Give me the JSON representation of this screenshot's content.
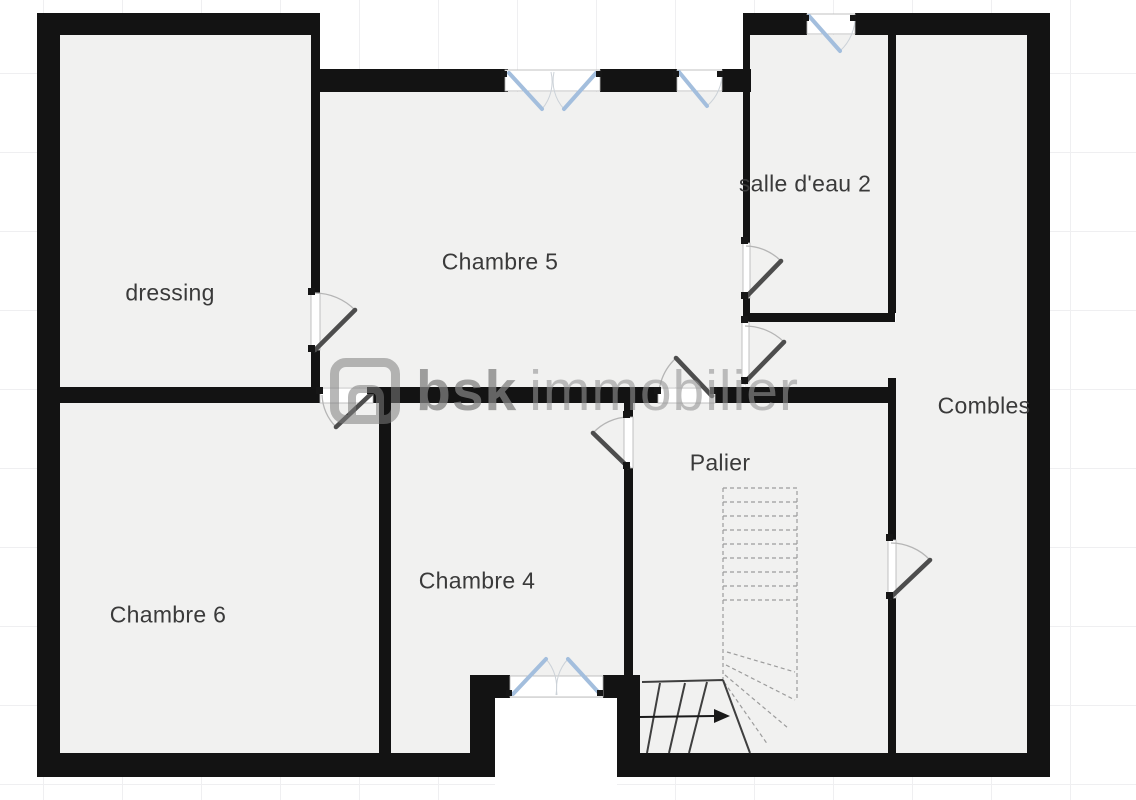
{
  "floorplan": {
    "rooms": [
      {
        "name": "dressing"
      },
      {
        "name": "Chambre 5"
      },
      {
        "name": "salle d'eau 2"
      },
      {
        "name": "Combles"
      },
      {
        "name": "Palier"
      },
      {
        "name": "Chambre 4"
      },
      {
        "name": "Chambre 6"
      }
    ],
    "watermark": {
      "bold": "bsk",
      "rest": "immobilier"
    },
    "stairs": {
      "arrow_direction": "right"
    },
    "colors": {
      "wall": "#131313",
      "room": "#f1f1f0",
      "window": "#a3bedd",
      "leaf": "#4d4d4d",
      "arc": "#b5b5b5",
      "label": "#3a3a3a",
      "grid": "#efeff1"
    }
  }
}
